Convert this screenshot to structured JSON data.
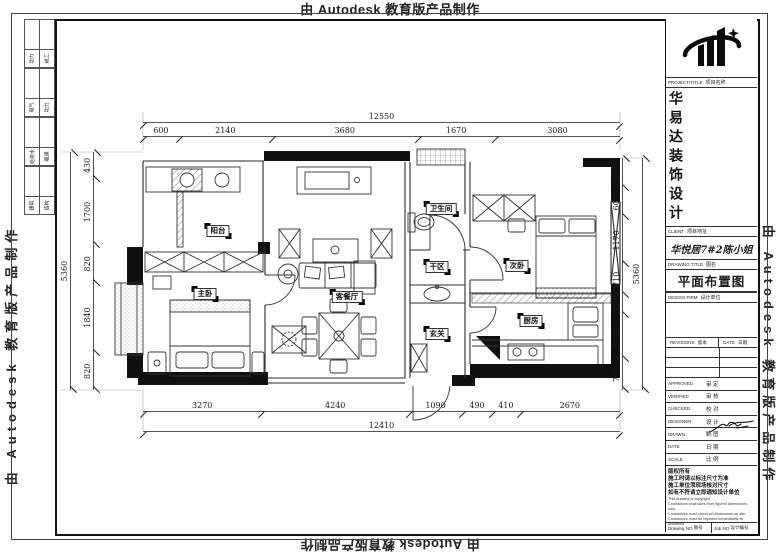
{
  "watermark": {
    "text": "由 Autodesk 教育版产品制作"
  },
  "signoff_strip": {
    "groups": [
      {
        "left": "动力",
        "right": "竣工"
      },
      {
        "left": "电气",
        "right": "动力"
      },
      {
        "left": "给排水",
        "right": "暖通"
      },
      {
        "left": "建筑",
        "right": "结构"
      }
    ]
  },
  "title_block": {
    "project_label_en": "PROJECT/TITLE",
    "project_label_zh": "项目名称",
    "company_name": "华易达装饰设计",
    "client_label_en": "CLIENT",
    "client_label_zh": "项目地址",
    "client_value": "华悦居7#2陈小姐",
    "drawing_title_label_en": "DRAWING TITLE",
    "drawing_title_label_zh": "图名",
    "drawing_title": "平面布置图",
    "design_firm_label_en": "DESIGN FIRM",
    "design_firm_label_zh": "设计单位",
    "revisions_en": "REVISIONS",
    "revisions_zh": "版本",
    "revisions_date_en": "DATE",
    "revisions_date_zh": "日期",
    "signature_rows": [
      {
        "en": "APPROVED",
        "zh": "审 定"
      },
      {
        "en": "VERIFIED",
        "zh": "审 核"
      },
      {
        "en": "CHECKED",
        "zh": "校 对"
      },
      {
        "en": "DESIGNER",
        "zh": "设 计"
      },
      {
        "en": "DRAWN",
        "zh": "制 图"
      },
      {
        "en": "DATE",
        "zh": "日 期"
      },
      {
        "en": "SCALE",
        "zh": "比 例"
      }
    ],
    "notes_zh": [
      "版权所有",
      "施工时请以标注尺寸为准",
      "施工单位须现场核对尺寸",
      "如有不符请立即通知设计单位"
    ],
    "notes_en": [
      "This drawing is copyright",
      "Contractors shall work from figured dimensions only",
      "Contractors must check all dimensions on site",
      "Contractors must be reported immediately to architects"
    ],
    "drawing_no_en": "Drawing NO",
    "drawing_no_zh": "图号",
    "job_no_en": "Job NO",
    "job_no_zh": "设计编号"
  },
  "plan": {
    "rooms": {
      "balcony": "阳台",
      "master_bedroom": "主卧",
      "living_dining": "客餐厅",
      "bathroom": "卫生间",
      "dry_area": "干区",
      "entry": "玄关",
      "second_bedroom": "次卧",
      "kitchen": "厨房"
    },
    "dims": {
      "top_overall": "12550",
      "top": [
        "600",
        "2140",
        "3680",
        "1670",
        "3080"
      ],
      "bottom": [
        "3270",
        "4240",
        "1090",
        "490",
        "410",
        "2670"
      ],
      "bottom_overall": "12410",
      "left": [
        "430",
        "1700",
        "820",
        "1840",
        "820"
      ],
      "left_overall": "5360",
      "right": [
        "670",
        "600",
        "1170",
        "710",
        "220",
        "1040",
        "710"
      ],
      "right_overall": "5360"
    }
  }
}
